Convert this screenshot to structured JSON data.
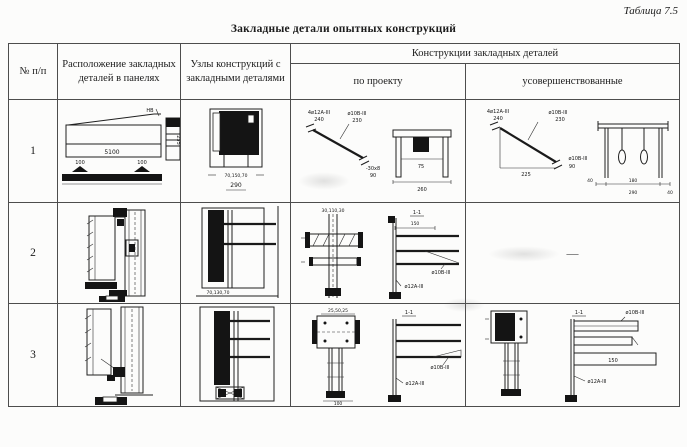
{
  "page": {
    "table_ref": "Таблица 7.5",
    "title": "Закладные детали опытных конструкций"
  },
  "headers": {
    "num": "№ п/п",
    "location": "Расположение закладных деталей в панелях",
    "nodes": "Узлы конструкций с закладными деталями",
    "constructions": "Конструкции закладных деталей",
    "by_project": "по проекту",
    "improved": "усовершенствованные"
  },
  "rows": {
    "r1": {
      "num": "1",
      "loc": {
        "len": "5100",
        "d1": "100",
        "d2": "100",
        "h": "235",
        "top": "НВ"
      },
      "node": {
        "dims": "70,150,70",
        "total": "290"
      },
      "proj": {
        "a1": "4ø12А-III",
        "a1d": "240",
        "a2": "ø10В-III",
        "a2d": "230",
        "a3": "-30х8",
        "a3d": "90",
        "f1": "75",
        "f2": "260"
      },
      "impr": {
        "a1": "4ø12А-III",
        "a1d": "240",
        "a2": "ø10В-III",
        "a2d": "230",
        "base": "225",
        "a3": "ø10В-III",
        "a3d": "90",
        "f1": "40",
        "f2": "180",
        "f3": "40",
        "f4": "290"
      }
    },
    "r2": {
      "num": "2",
      "node": {
        "dims": "70,130,70"
      },
      "proj": {
        "p1": "30,110,30",
        "s1": "1-1",
        "s2": "150",
        "a1": "ø10В-III",
        "a2": "ø12А-III"
      },
      "impr": {
        "dash": "—"
      }
    },
    "r3": {
      "num": "3",
      "proj": {
        "p1": "25,50,25",
        "p2": "100",
        "s1": "1-1",
        "a1": "ø10В-III",
        "a2": "ø12А-III"
      },
      "impr": {
        "s1": "1-1",
        "a0": "ø10В-III",
        "mid": "150",
        "a2": "ø12А-III"
      }
    }
  }
}
